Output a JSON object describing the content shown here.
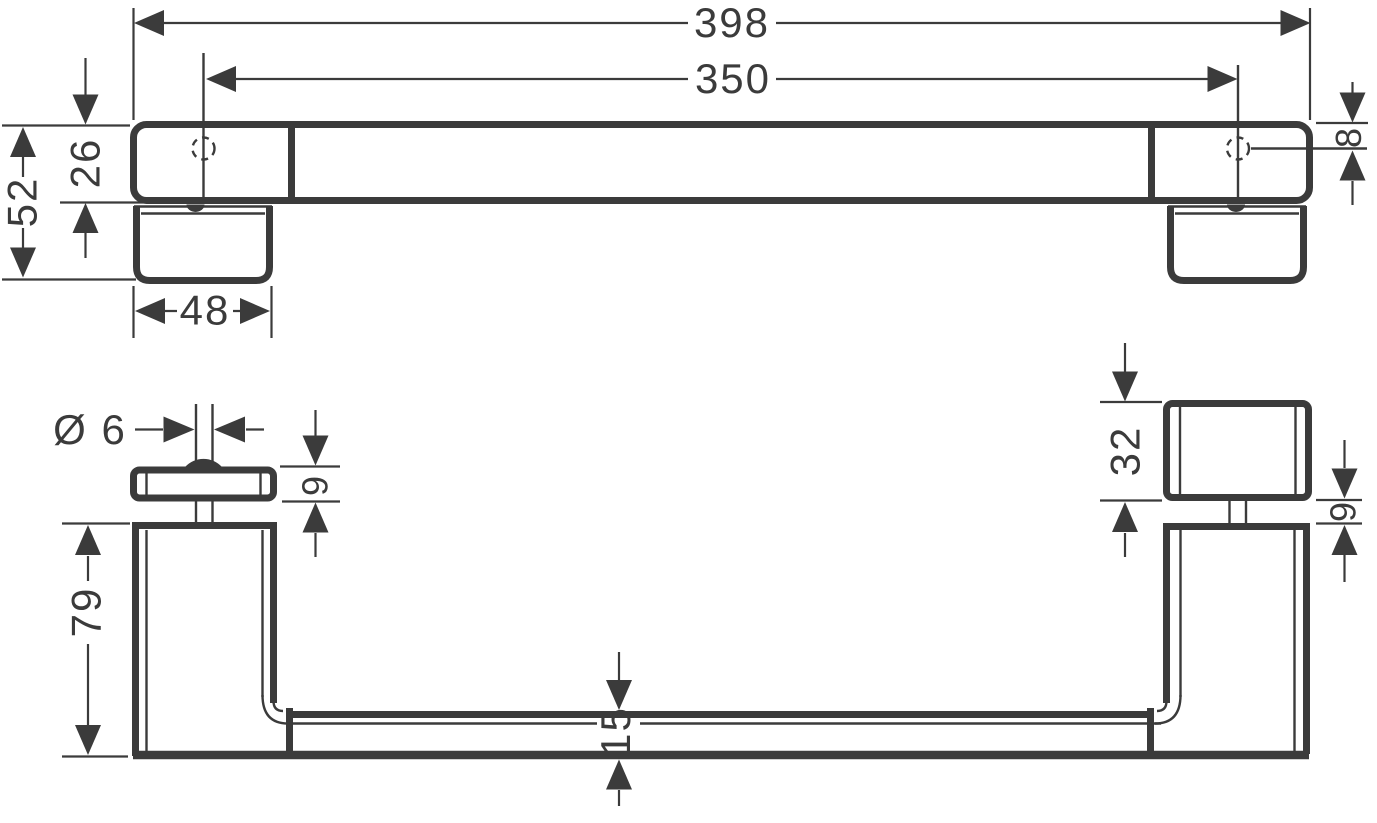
{
  "drawing": {
    "type": "technical-dimension-drawing",
    "part": "door-handle-grab-bar",
    "views": [
      "front-elevation",
      "side-profile"
    ]
  },
  "colors": {
    "line": "#3b3b3b",
    "background": "#ffffff"
  },
  "dims": {
    "overall_length": "398",
    "hole_spacing": "350",
    "total_height": "52",
    "bar_height": "26",
    "mount_width": "48",
    "hole_edge_offset": "8",
    "pin_diameter": "Ø 6",
    "plate_thickness": "9",
    "post_height": "79",
    "handle_depth": "15",
    "mount_box_height": "32",
    "pin_gap": "9"
  }
}
